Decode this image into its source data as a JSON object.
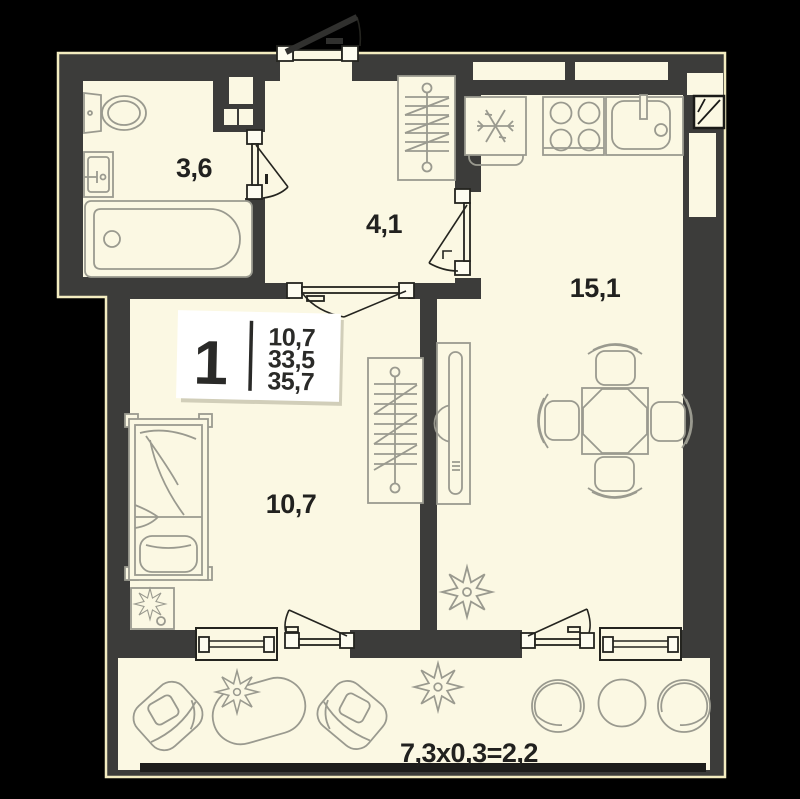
{
  "plan_title": "1-room apartment floor plan",
  "unit_card": {
    "rooms_count": "1",
    "living_area": "10,7",
    "area_without_balcony": "33,5",
    "total_area": "35,7"
  },
  "room_labels": {
    "bathroom": "3,6",
    "hallway": "4,1",
    "kitchen_living": "15,1",
    "bedroom": "10,7",
    "balcony_formula": "7,3х0,3=2,2"
  },
  "colors": {
    "background": "#000000",
    "walls": "#3c3c3a",
    "floor": "#fbf8e3",
    "outer_outline": "#f3ecc0",
    "furniture_line": "#9a9a8f",
    "door_line": "#24241f",
    "text": "#21211f",
    "card_background": "#ffffff",
    "balcony_rail": "#1d1d1b"
  }
}
